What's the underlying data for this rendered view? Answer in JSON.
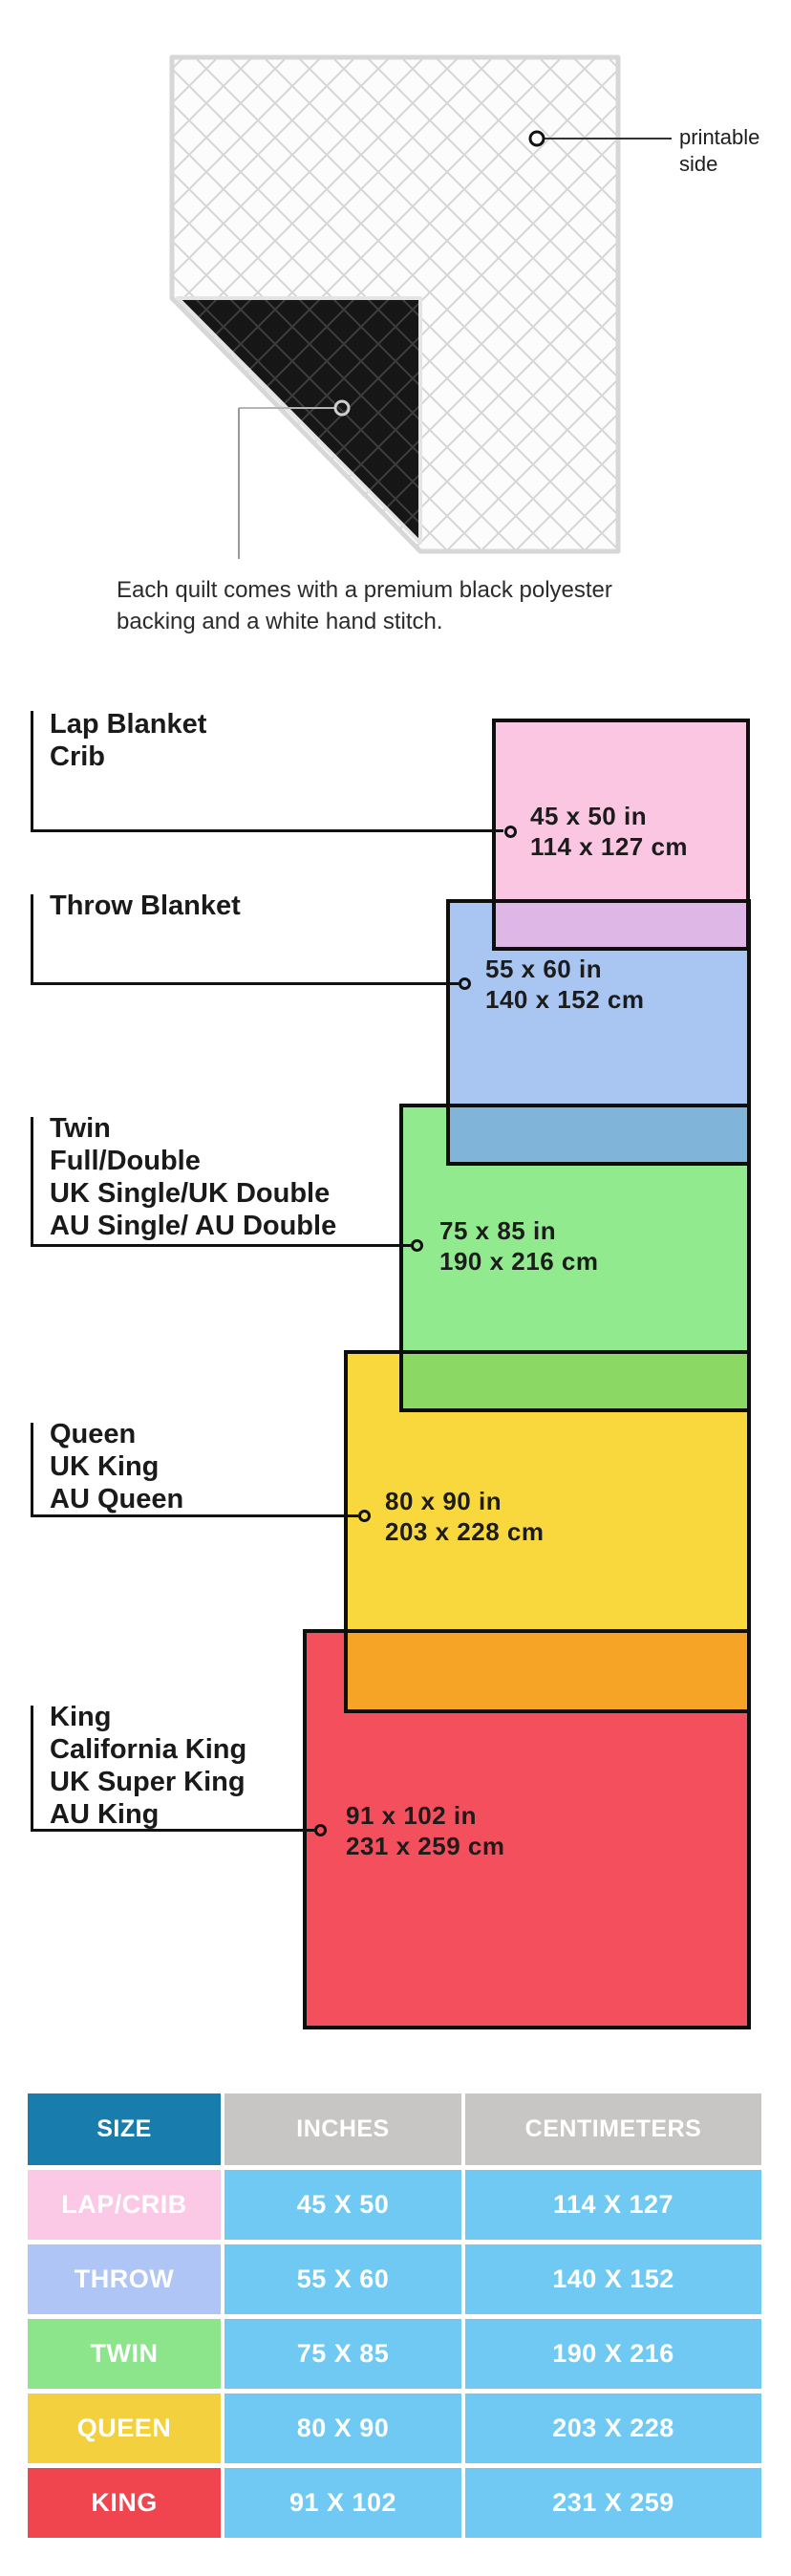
{
  "quilt_section": {
    "printable_lines": [
      "printable",
      "side"
    ],
    "caption_lines": [
      "Each quilt comes with a premium black polyester",
      "backing and a white hand stitch."
    ]
  },
  "diagram": {
    "items": [
      {
        "labels": [
          "Lap Blanket",
          "Crib"
        ],
        "inches": "45 x 50 in",
        "cm": "114 x 127 cm",
        "fill": "#fbc6e2"
      },
      {
        "labels": [
          "Throw Blanket"
        ],
        "inches": "55 x 60 in",
        "cm": "140 x 152 cm",
        "fill": "#a9c6f3"
      },
      {
        "labels": [
          "Twin",
          "Full/Double",
          "UK Single/UK Double",
          "AU Single/ AU Double"
        ],
        "inches": "75 x 85 in",
        "cm": "190 x 216 cm",
        "fill": "#92ea8f"
      },
      {
        "labels": [
          "Queen",
          "UK King",
          "AU Queen"
        ],
        "inches": "80 x 90 in",
        "cm": "203 x 228 cm",
        "fill": "#f8d83d"
      },
      {
        "labels": [
          "King",
          "California King",
          "UK Super King",
          "AU King"
        ],
        "inches": "91 x 102 in",
        "cm": "231 x 259 cm",
        "fill": "#f44f5d"
      }
    ],
    "overlaps": {
      "pink_blue": "#dfb7e7",
      "blue_green": "#80b5d9",
      "green_yellow": "#8bd964",
      "yellow_red": "#f5a426"
    },
    "border_color": "#0e0e0e"
  },
  "table": {
    "headers": [
      "SIZE",
      "INCHES",
      "CENTIMETERS"
    ],
    "header_colors": {
      "size": "#187dac",
      "other": "#c7c6c4"
    },
    "cell_color": "#6fc9f3",
    "rows": [
      {
        "size": "LAP/CRIB",
        "inches": "45 X 50",
        "cm": "114 X 127",
        "color": "#fbc9e6"
      },
      {
        "size": "THROW",
        "inches": "55 X 60",
        "cm": "140 X 152",
        "color": "#aec5f6"
      },
      {
        "size": "TWIN",
        "inches": "75 X 85",
        "cm": "190 X 216",
        "color": "#8ce58a"
      },
      {
        "size": "QUEEN",
        "inches": "80 X 90",
        "cm": "203 X 228",
        "color": "#f3d03e"
      },
      {
        "size": "KING",
        "inches": "91 X 102",
        "cm": "231 X 259",
        "color": "#f0444f"
      }
    ]
  }
}
